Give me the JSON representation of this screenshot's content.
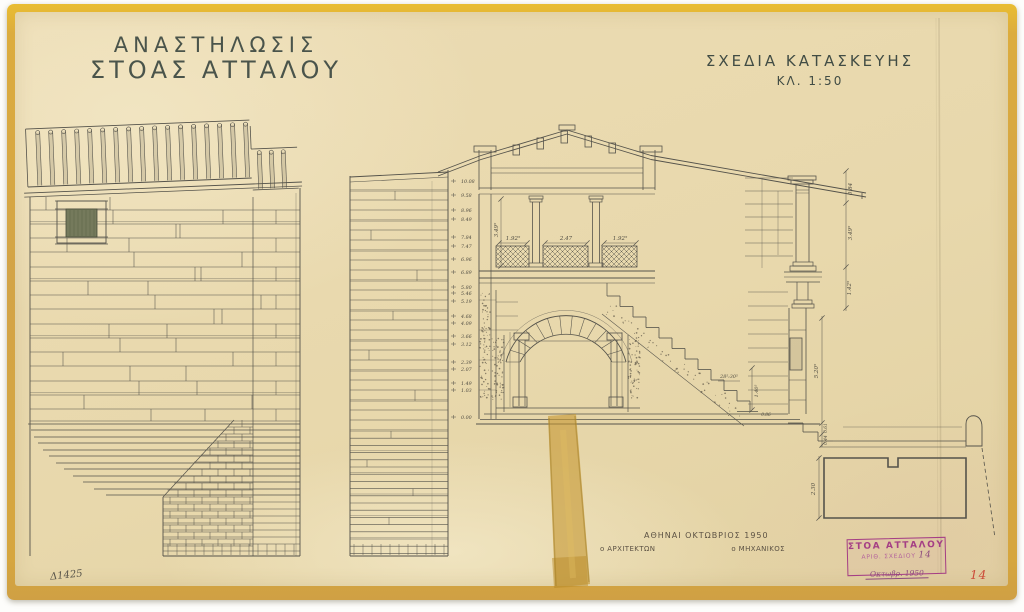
{
  "header": {
    "title_line1": "ΑΝΑΣΤΗΛΩΣΙΣ",
    "title_line2": "ΣΤΟΑΣ ΑΤΤΑΛΟΥ",
    "subtitle": "ΣΧΕΔΙΑ ΚΑΤΑΣΚΕΥΗΣ",
    "scale": "ΚΛ. 1:50"
  },
  "footer": {
    "place_date": "ΑΘΗΝΑΙ ΟΚΤΩΒΡΙΟΣ 1950",
    "architect": "ο ΑΡΧΙΤΕΚΤΩΝ",
    "engineer": "ο ΜΗΧΑΝΙΚΟΣ",
    "inventory_no": "Δ1425",
    "page_no": "14"
  },
  "stamp": {
    "line1": "ΣΤΟΑ ΑΤΤΑΛΟΥ",
    "line2": "ΑΡΙΘ. ΣΧΕΔΙΟΥ",
    "number": "14",
    "date": "Οκτωβρ. 1950"
  },
  "section": {
    "levels": [
      "10.08",
      "9.58",
      "8.96",
      "8.49",
      "7.84",
      "7.47",
      "6.96",
      "6.89",
      "5.80",
      "5.46",
      "5.19",
      "4.68",
      "4.09",
      "3.66",
      "3.12",
      "2.39",
      "2.07",
      "1.49",
      "1.03",
      "0.00"
    ],
    "bay_dims": [
      "1.92⁵",
      "2.47",
      "1.92⁵"
    ],
    "upper_height": "3.49⁵",
    "right_dims": [
      "0.84",
      "3.49⁵",
      "1.42⁵",
      "5.20⁵",
      "0.61",
      "0.44"
    ],
    "stair_note": "28⁵:30⁵",
    "stair_height": "1.40⁵",
    "stair_base": "0.86",
    "foundation_height": "2.30"
  },
  "colors": {
    "paper": "#e8d8ac",
    "backing_gold": "#d5a545",
    "ink": "#55534b",
    "stamp_purple": "#a53f85",
    "page_number_red": "#cc4a38",
    "tape": "#c79a35"
  }
}
